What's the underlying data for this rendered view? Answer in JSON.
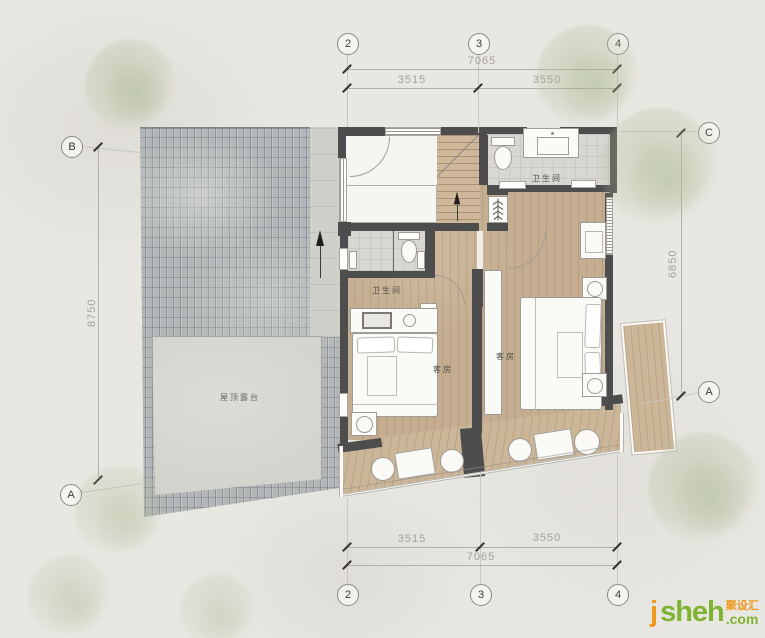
{
  "labels": {
    "roof_terrace": "屋顶露台",
    "bathroom_top": "卫生间",
    "bathroom_left": "卫生间",
    "guest_left": "客房",
    "guest_right": "客房"
  },
  "axes": {
    "col_2": "2",
    "col_3": "3",
    "col_4": "4",
    "row_a": "A",
    "row_b": "B",
    "row_c": "C"
  },
  "dims": {
    "top_overall": "7065",
    "top_left": "3515",
    "top_right": "3550",
    "bottom_left": "3515",
    "bottom_right": "3550",
    "bottom_overall": "7065",
    "left_overall": "8750",
    "right_overall": "6850"
  },
  "watermark": {
    "j": "j",
    "sheh": "sheh",
    "cn": "聚设汇",
    "com": ".com"
  },
  "colors": {
    "wall": "#4d4d4e",
    "wood_floor": "#c4ad90",
    "tile_floor": "#d8d7d3",
    "roof_tiles": "#b2b6b7",
    "terrace": "#d4d3ce",
    "background": "#e9e7e2",
    "tree": "#aab890",
    "dimension_line": "#b3b0aa",
    "logo_orange": "#f0981d",
    "logo_green": "#7fb432"
  }
}
